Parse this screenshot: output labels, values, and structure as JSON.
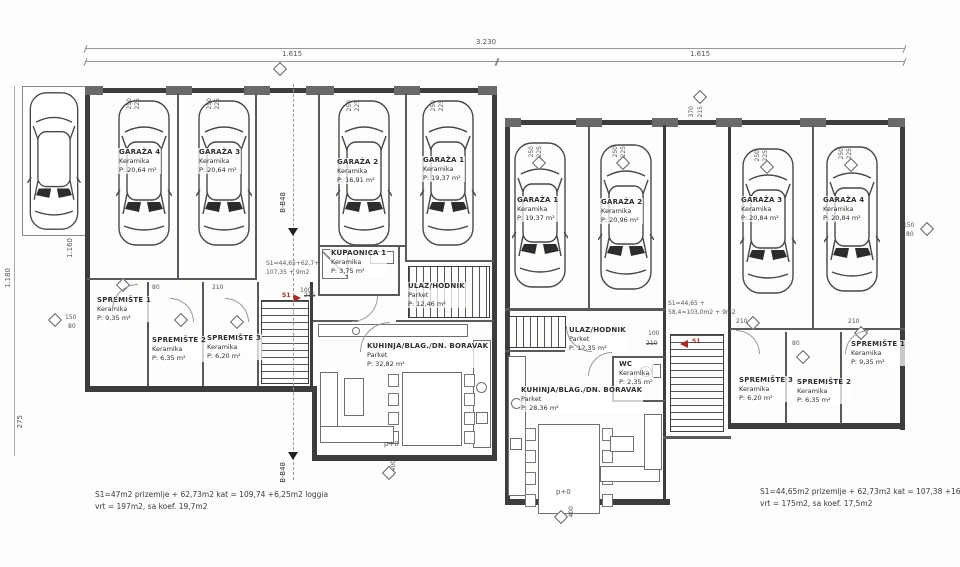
{
  "dims": {
    "top_total": "3.230",
    "top_left": "1.615",
    "top_right": "1.615",
    "v_1180": "1.180",
    "v_1160": "1.160",
    "v_275": "275",
    "g250": "250",
    "g225": "225",
    "w150": "150",
    "w80": "80",
    "w370": "370",
    "w215": "215",
    "d100": "100",
    "d210": "210",
    "d215": "215",
    "b400": "400"
  },
  "levels": {
    "left": "p+0",
    "right": "p+0"
  },
  "section_label": "B-B48",
  "stair_note_left": {
    "line1": "S1=44,65+62,7+",
    "line2": "107,35 + 9m2",
    "marker": "S1"
  },
  "stair_note_right": {
    "line1": "S1=44,65 +",
    "line2": "58,4=103,0m2 + 9m2",
    "marker": "S1"
  },
  "notes": {
    "left_line1": "S1=47m2 prizemlje + 62,73m2 kat = 109,74 +6,25m2 loggia",
    "left_line2": "vrt = 197m2, sa koef. 19,7m2",
    "right_line1": "S1=44,65m2 prizemlje + 62,73m2 kat = 107,38 +16,6m2 loggia",
    "right_line2": "vrt = 175m2, sa koef. 17,5m2"
  },
  "left_house": {
    "garaza4": {
      "name": "GARAŽA 4",
      "material": "Keramika",
      "area": "P: 20,64 m²"
    },
    "garaza3": {
      "name": "GARAŽA 3",
      "material": "Keramika",
      "area": "P: 20,64 m²"
    },
    "garaza2": {
      "name": "GARAŽA 2",
      "material": "Keramika",
      "area": "P: 16,91 m²"
    },
    "garaza1": {
      "name": "GARAŽA 1",
      "material": "Keramika",
      "area": "P: 19,37 m²"
    },
    "spremiste1": {
      "name": "SPREMIŠTE 1",
      "material": "Keramika",
      "area": "P: 9,35 m²"
    },
    "spremiste2": {
      "name": "SPREMIŠTE 2",
      "material": "Keramika",
      "area": "P: 6,35 m²"
    },
    "spremiste3": {
      "name": "SPREMIŠTE 3",
      "material": "Keramika",
      "area": "P: 6,20 m²"
    },
    "kupaonica": {
      "name": "KUPAONICA 1",
      "material": "Keramika",
      "area": "P: 3,75 m²"
    },
    "ulaz": {
      "name": "ULAZ/HODNIK",
      "material": "Parket",
      "area": "P: 12,46 m²"
    },
    "kuhinja": {
      "name": "KUHINJA/BLAG./DN. BORAVAK",
      "material": "Parket",
      "area": "P: 32,82 m²"
    }
  },
  "right_house": {
    "garaza1": {
      "name": "GARAŽA 1",
      "material": "Keramika",
      "area": "P: 19,37 m²"
    },
    "garaza2": {
      "name": "GARAŽA 2",
      "material": "Keramika",
      "area": "P: 20,96 m²"
    },
    "garaza3": {
      "name": "GARAŽA 3",
      "material": "Keramika",
      "area": "P: 20,84 m²"
    },
    "garaza4": {
      "name": "GARAŽA 4",
      "material": "Keramika",
      "area": "P: 20,84 m²"
    },
    "ulaz": {
      "name": "ULAZ/HODNIK",
      "material": "Parket",
      "area": "P: 12,35 m²"
    },
    "wc": {
      "name": "WC",
      "material": "Keramika",
      "area": "P: 2,35 m²"
    },
    "kuhinja": {
      "name": "KUHINJA/BLAG./DN. BORAVAK",
      "material": "Parket",
      "area": "P: 28,36 m²"
    },
    "spremiste3": {
      "name": "SPREMIŠTE 3",
      "material": "Keramika",
      "area": "P: 6,20 m²"
    },
    "spremiste2": {
      "name": "SPREMIŠTE 2",
      "material": "Keramika",
      "area": "P: 6,35 m²"
    },
    "spremiste1": {
      "name": "SPREMIŠTE 1",
      "material": "Keramika",
      "area": "P: 9,35 m²"
    }
  },
  "colors": {
    "line": "#3d3d3d",
    "marker_red": "#b3261e"
  }
}
